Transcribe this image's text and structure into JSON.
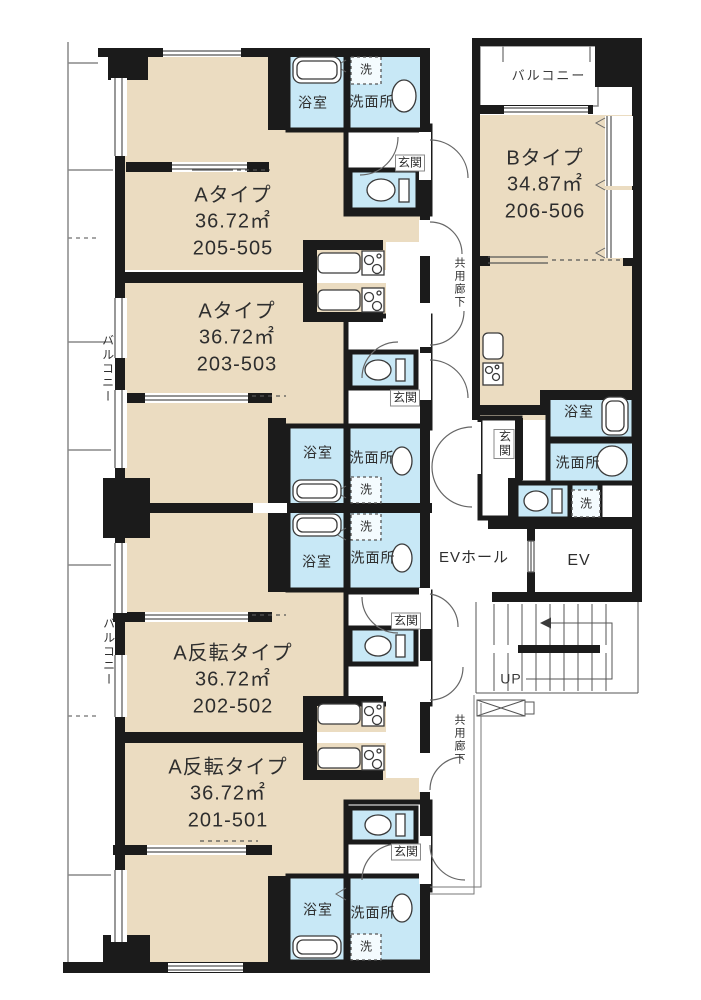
{
  "page": {
    "type": "apartment-floor-plan"
  },
  "colors": {
    "wall": "#1b1b1b",
    "room_fill": "#EBDCC1",
    "wet_fill": "#C8E8F6",
    "fixture_line": "#3a3a3a",
    "outline": "#777777",
    "text": "#2e2e2e"
  },
  "units": {
    "a_205": {
      "type": "Aタイプ",
      "area": "36.72㎡",
      "rooms": "205-505"
    },
    "a_203": {
      "type": "Aタイプ",
      "area": "36.72㎡",
      "rooms": "203-503"
    },
    "b_206": {
      "type": "Bタイプ",
      "area": "34.87㎡",
      "rooms": "206-506"
    },
    "a_rev_202": {
      "type": "A反転タイプ",
      "area": "36.72㎡",
      "rooms": "202-502"
    },
    "a_rev_201": {
      "type": "A反転タイプ",
      "area": "36.72㎡",
      "rooms": "201-501"
    }
  },
  "labels": {
    "balcony": "バルコニー",
    "bath": "浴室",
    "washroom": "洗面所",
    "laundry": "洗",
    "entrance": "玄関",
    "shared_corridor": "共用廊下",
    "ev_hall": "EVホール",
    "ev": "EV",
    "up": "UP"
  }
}
